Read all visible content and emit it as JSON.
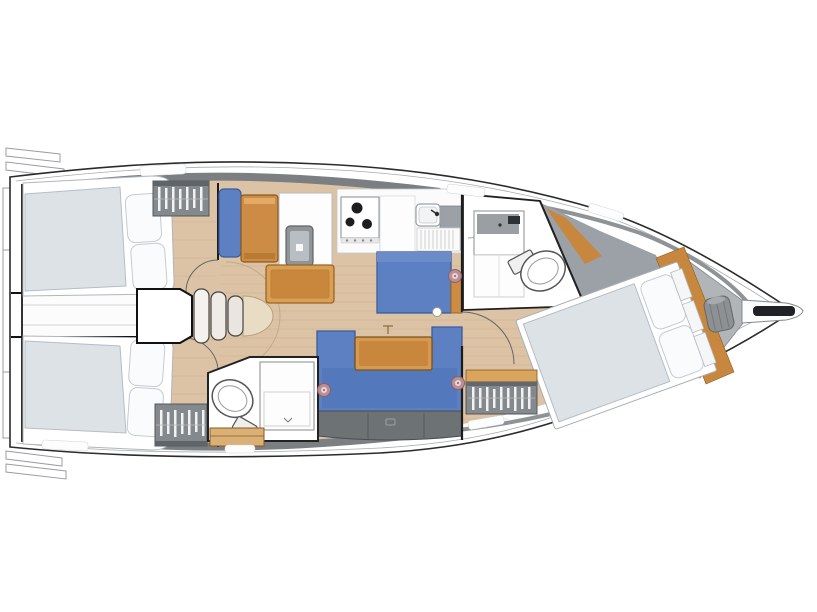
{
  "meta": {
    "type": "boat-floor-plan",
    "subject": "sailing-yacht-interior-layout-top-view",
    "orientation": "bow-right",
    "background": "#ffffff"
  },
  "colors": {
    "hull_outline": "#2b2b2b",
    "hull_inner_line": "#a7aaad",
    "deck_band": "#7b7f82",
    "deck_band_light": "#8f9396",
    "floor_wood": "#dcc3a5",
    "plank_line": "#c9a87f",
    "furniture_wood": "#cd8c45",
    "furniture_wood_light": "#d89f55",
    "furniture_wood_dark": "#8a5a20",
    "table_wood": "#d49a52",
    "teak_trim": "#c8873f",
    "upholstery_blue": "#5d80c2",
    "upholstery_blue_dark": "#3a5c9e",
    "mattress_grey": "#dde2e7",
    "mattress_edge": "#b6bdc5",
    "locker_grey": "#84898d",
    "locker_dark_grey": "#6d7275",
    "clothes_white": "#f2f2f2",
    "shower_grey": "#9ba1a6",
    "anchor_grey": "#b2b5b8",
    "windlass_grey": "#8e9194",
    "appliance_grey": "#8f9498",
    "engine_step_beige": "#e9dcc4",
    "speaker_pink": "#bb8f96",
    "speaker_ring": "#8d5f66",
    "white": "#ffffff"
  },
  "regions": [
    {
      "id": "stern-platform",
      "name": "stern swim platform"
    },
    {
      "id": "aft-cabin-top",
      "name": "aft double cabin (starboard)"
    },
    {
      "id": "aft-cabin-bottom",
      "name": "aft double cabin (port)"
    },
    {
      "id": "aft-head",
      "name": "aft bathroom with toilet"
    },
    {
      "id": "companionway",
      "name": "companionway steps"
    },
    {
      "id": "nav-station",
      "name": "chart table with seat"
    },
    {
      "id": "galley",
      "name": "galley with stove and sink"
    },
    {
      "id": "salon",
      "name": "salon with settees and table"
    },
    {
      "id": "forward-head",
      "name": "forward bathroom with toilet and sink"
    },
    {
      "id": "forward-cabin",
      "name": "forward cabin with island berth"
    },
    {
      "id": "anchor-locker",
      "name": "bow anchor locker with windlass"
    },
    {
      "id": "bowsprit",
      "name": "bowsprit with anchor roller"
    }
  ]
}
